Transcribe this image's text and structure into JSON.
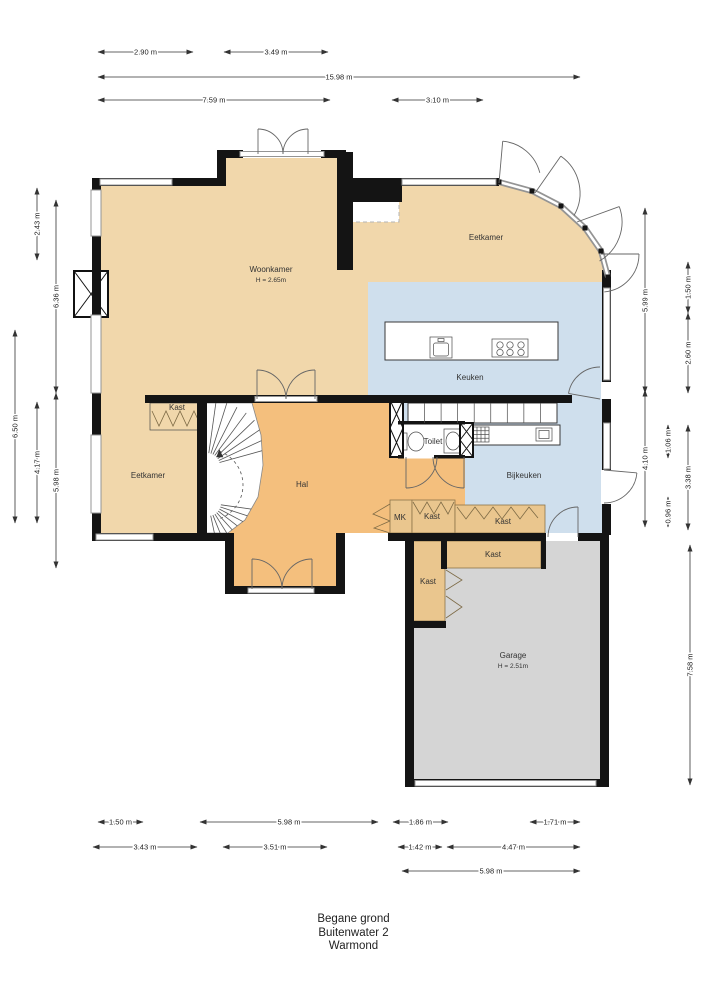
{
  "meta": {
    "title_lines": [
      "Begane grond",
      "Buitenwater 2",
      "Warmond"
    ]
  },
  "colors": {
    "floor_tan": "#f1d7ab",
    "floor_orange": "#f4bf7d",
    "floor_kast": "#eac68e",
    "floor_blue": "#cfdfed",
    "floor_gray": "#d5d5d5",
    "wall": "#141414"
  },
  "rooms": [
    {
      "id": "woonkamer",
      "label": "Woonkamer",
      "sub": "H = 2.65m",
      "x": 271,
      "y": 272
    },
    {
      "id": "eetkamer-boven",
      "label": "Eetkamer",
      "x": 486,
      "y": 240
    },
    {
      "id": "keuken",
      "label": "Keuken",
      "x": 470,
      "y": 380
    },
    {
      "id": "kast-eetkamer",
      "label": "Kast",
      "x": 177,
      "y": 410
    },
    {
      "id": "eetkamer-links",
      "label": "Eetkamer",
      "x": 148,
      "y": 478
    },
    {
      "id": "hal",
      "label": "Hal",
      "x": 302,
      "y": 487
    },
    {
      "id": "toilet",
      "label": "Toilet",
      "x": 433,
      "y": 444
    },
    {
      "id": "bijkeuken",
      "label": "Bijkeuken",
      "x": 524,
      "y": 478
    },
    {
      "id": "mk",
      "label": "MK",
      "x": 400,
      "y": 520
    },
    {
      "id": "kast-hal",
      "label": "Kast",
      "x": 432,
      "y": 519
    },
    {
      "id": "kast-bijkeuken",
      "label": "Kast",
      "x": 503,
      "y": 524
    },
    {
      "id": "kast-garage-breed",
      "label": "Kast",
      "x": 493,
      "y": 557
    },
    {
      "id": "kast-garage-hoog",
      "label": "Kast",
      "x": 428,
      "y": 584
    },
    {
      "id": "garage",
      "label": "Garage",
      "sub": "H = 2.51m",
      "x": 513,
      "y": 658
    }
  ],
  "dimensions": {
    "top": [
      {
        "label": "2.90 m",
        "x1": 98,
        "x2": 193,
        "y": 52
      },
      {
        "label": "3.49 m",
        "x1": 224,
        "x2": 328,
        "y": 52
      },
      {
        "label": "15.98 m",
        "x1": 98,
        "x2": 580,
        "y": 77
      },
      {
        "label": "7.59 m",
        "x1": 98,
        "x2": 330,
        "y": 100
      },
      {
        "label": "3.10 m",
        "x1": 392,
        "x2": 483,
        "y": 100
      }
    ],
    "bottom": [
      {
        "label": "1.50 m",
        "x1": 98,
        "x2": 143,
        "y": 822
      },
      {
        "label": "5.98 m",
        "x1": 200,
        "x2": 378,
        "y": 822
      },
      {
        "label": "1.86 m",
        "x1": 393,
        "x2": 448,
        "y": 822
      },
      {
        "label": "1.71 m",
        "x1": 530,
        "x2": 580,
        "y": 822
      },
      {
        "label": "3.43 m",
        "x1": 93,
        "x2": 197,
        "y": 847
      },
      {
        "label": "3.51 m",
        "x1": 223,
        "x2": 327,
        "y": 847
      },
      {
        "label": "1.42 m",
        "x1": 398,
        "x2": 442,
        "y": 847
      },
      {
        "label": "4.47 m",
        "x1": 447,
        "x2": 580,
        "y": 847
      },
      {
        "label": "5.98 m",
        "x1": 402,
        "x2": 580,
        "y": 871
      }
    ],
    "left": [
      {
        "label": "2.43 m",
        "x": 37,
        "y1": 188,
        "y2": 260
      },
      {
        "label": "6.36 m",
        "x": 56,
        "y1": 200,
        "y2": 393
      },
      {
        "label": "6.50 m",
        "x": 15,
        "y1": 330,
        "y2": 523
      },
      {
        "label": "4.17 m",
        "x": 37,
        "y1": 402,
        "y2": 523
      },
      {
        "label": "5.98 m",
        "x": 56,
        "y1": 393,
        "y2": 568
      }
    ],
    "right": [
      {
        "label": "5.99 m",
        "x": 645,
        "y1": 208,
        "y2": 393
      },
      {
        "label": "4.10 m",
        "x": 645,
        "y1": 390,
        "y2": 527
      },
      {
        "label": "1.06 m",
        "x": 668,
        "y1": 425,
        "y2": 458
      },
      {
        "label": "0.96 m",
        "x": 668,
        "y1": 497,
        "y2": 527
      },
      {
        "label": "1.50 m",
        "x": 688,
        "y1": 262,
        "y2": 313
      },
      {
        "label": "2.60 m",
        "x": 688,
        "y1": 313,
        "y2": 393
      },
      {
        "label": "3.38 m",
        "x": 688,
        "y1": 425,
        "y2": 530
      },
      {
        "label": "7.58 m",
        "x": 690,
        "y1": 545,
        "y2": 785
      }
    ]
  }
}
